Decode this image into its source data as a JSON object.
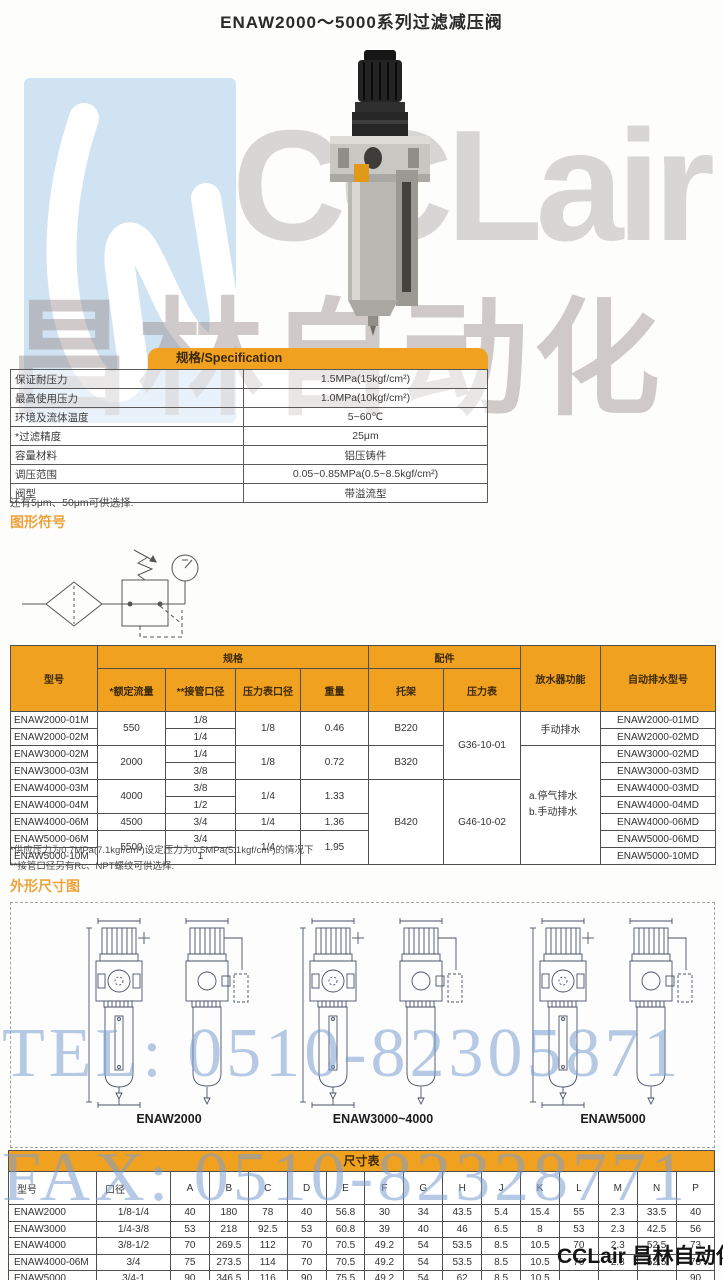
{
  "page": {
    "title": "ENAW2000～5000系列过滤减压阀"
  },
  "watermarks": {
    "brand_text": "CCLair",
    "brand_cn": "昌林自动化",
    "tel": "TEL: 0510-82305871",
    "fax": "FAX: 0510-82328771",
    "footer_brand": "CCLair 昌林自动化"
  },
  "spec_table": {
    "header": "规格/Specification",
    "rows": [
      {
        "label": "保证耐压力",
        "value": "1.5MPa(15kgf/cm²)"
      },
      {
        "label": "最高使用压力",
        "value": "1.0MPa(10kgf/cm²)"
      },
      {
        "label": "环境及流体温度",
        "value": "5~60℃"
      },
      {
        "label": "*过滤精度",
        "value": "25μm"
      },
      {
        "label": "容量材料",
        "value": "铝压铸件"
      },
      {
        "label": "调压范围",
        "value": "0.05~0.85MPa(0.5~8.5kgf/cm²)"
      },
      {
        "label": "阀型",
        "value": "带溢流型"
      }
    ],
    "note": "还有5μm、50μm可供选择."
  },
  "symbol_section": {
    "title": "图形符号"
  },
  "model_table": {
    "head": {
      "model": "型号",
      "spec_group": "规格",
      "flow": "*额定流量",
      "port": "**接管口径",
      "gauge_port": "压力表口径",
      "weight": "重量",
      "acc_group": "配件",
      "bracket": "托架",
      "gauge": "压力表",
      "drain": "放水器功能",
      "auto_model": "自动排水型号"
    },
    "models": [
      "ENAW2000-01M",
      "ENAW2000-02M",
      "ENAW3000-02M",
      "ENAW3000-03M",
      "ENAW4000-03M",
      "ENAW4000-04M",
      "ENAW4000-06M",
      "ENAW5000-06M",
      "ENAW5000-10M"
    ],
    "ports": [
      "1/8",
      "1/4",
      "1/4",
      "3/8",
      "3/8",
      "1/2",
      "3/4",
      "3/4",
      "1"
    ],
    "autos": [
      "ENAW2000-01MD",
      "ENAW2000-02MD",
      "ENAW3000-02MD",
      "ENAW3000-03MD",
      "ENAW4000-03MD",
      "ENAW4000-04MD",
      "ENAW4000-06MD",
      "ENAW5000-06MD",
      "ENAW5000-10MD"
    ],
    "merged": {
      "flow_12": "550",
      "flow_34": "2000",
      "flow_56": "4000",
      "flow_7": "4500",
      "flow_89": "5500",
      "gp_12": "1/8",
      "gp_34": "1/8",
      "gp_56": "1/4",
      "gp_7": "1/4",
      "gp_89": "1/4",
      "w_12": "0.46",
      "w_34": "0.72",
      "w_56": "1.33",
      "w_7": "1.36",
      "w_89": "1.95",
      "b_12": "B220",
      "b_34": "B320",
      "b_59": "B420",
      "g_14": "G36-10-01",
      "g_59": "G46-10-02",
      "drain_12": "手动排水",
      "drain_39_a": "a.停气排水",
      "drain_39_b": "b.手动排水"
    }
  },
  "notes": {
    "line1": "*供应压力为0.7MPa(7.1kgf/cm²)设定压力为0.5MPa(5.1kgf/cm²)的情况下",
    "line2": "**接管口径另有Rc、NPT螺纹可供选择."
  },
  "dimension_section": {
    "title": "外形尺寸图",
    "labels": [
      "ENAW2000",
      "ENAW3000~4000",
      "ENAW5000"
    ]
  },
  "dim_table": {
    "title": "尺寸表",
    "headers": [
      "型号",
      "口径",
      "A",
      "B",
      "C",
      "D",
      "E",
      "F",
      "G",
      "H",
      "J",
      "K",
      "L",
      "M",
      "N",
      "P"
    ],
    "rows": [
      [
        "ENAW2000",
        "1/8-1/4",
        "40",
        "180",
        "78",
        "40",
        "56.8",
        "30",
        "34",
        "43.5",
        "5.4",
        "15.4",
        "55",
        "2.3",
        "33.5",
        "40"
      ],
      [
        "ENAW3000",
        "1/4-3/8",
        "53",
        "218",
        "92.5",
        "53",
        "60.8",
        "39",
        "40",
        "46",
        "6.5",
        "8",
        "53",
        "2.3",
        "42.5",
        "56"
      ],
      [
        "ENAW4000",
        "3/8-1/2",
        "70",
        "269.5",
        "112",
        "70",
        "70.5",
        "49.2",
        "54",
        "53.5",
        "8.5",
        "10.5",
        "70",
        "2.3",
        "52.5",
        "73"
      ],
      [
        "ENAW4000-06M",
        "3/4",
        "75",
        "273.5",
        "114",
        "70",
        "70.5",
        "49.2",
        "54",
        "53.5",
        "8.5",
        "10.5",
        "70",
        "2.3",
        "52.5",
        "73"
      ],
      [
        "ENAW5000",
        "3/4-1",
        "90",
        "346.5",
        "116",
        "90",
        "75.5",
        "49.2",
        "54",
        "62",
        "8.5",
        "10.5",
        "",
        "",
        "",
        "90"
      ]
    ]
  },
  "colors": {
    "accent_orange": "#f1a120",
    "table_border": "#4f4f4f",
    "watermark_blue": "#7a9ed1",
    "watermark_gray": "#d7d6d5"
  }
}
